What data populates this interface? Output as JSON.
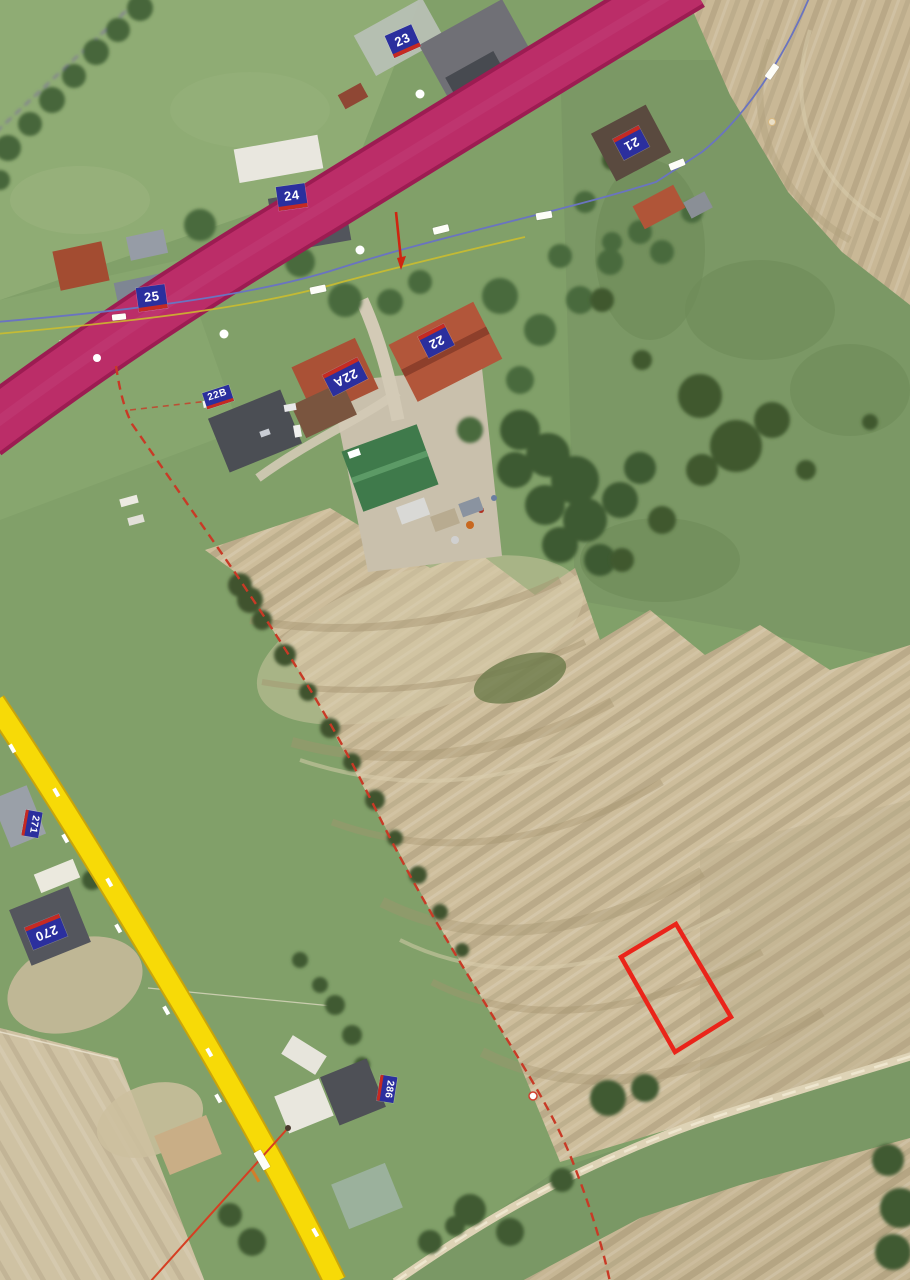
{
  "map": {
    "view_type": "aerial-cadastral-orthophoto",
    "house_number_labels": [
      {
        "text": "23"
      },
      {
        "text": "24"
      },
      {
        "text": "25"
      },
      {
        "text": "22"
      },
      {
        "text": "22A"
      },
      {
        "text": "21"
      },
      {
        "text": "22B"
      },
      {
        "text": "270"
      },
      {
        "text": "271"
      },
      {
        "text": "286"
      }
    ],
    "overlay_colors": {
      "primary_road": "#bb2d68",
      "primary_road_edge": "#9c1c52",
      "secondary_road": "#f7da07",
      "parcel_highlight": "#ea241a",
      "cadastral_boundary": "#c83a26",
      "utility_line": "#6a74c0",
      "house_number_bg": "#2b2f9e",
      "house_number_stripe": "#c62a22"
    }
  }
}
